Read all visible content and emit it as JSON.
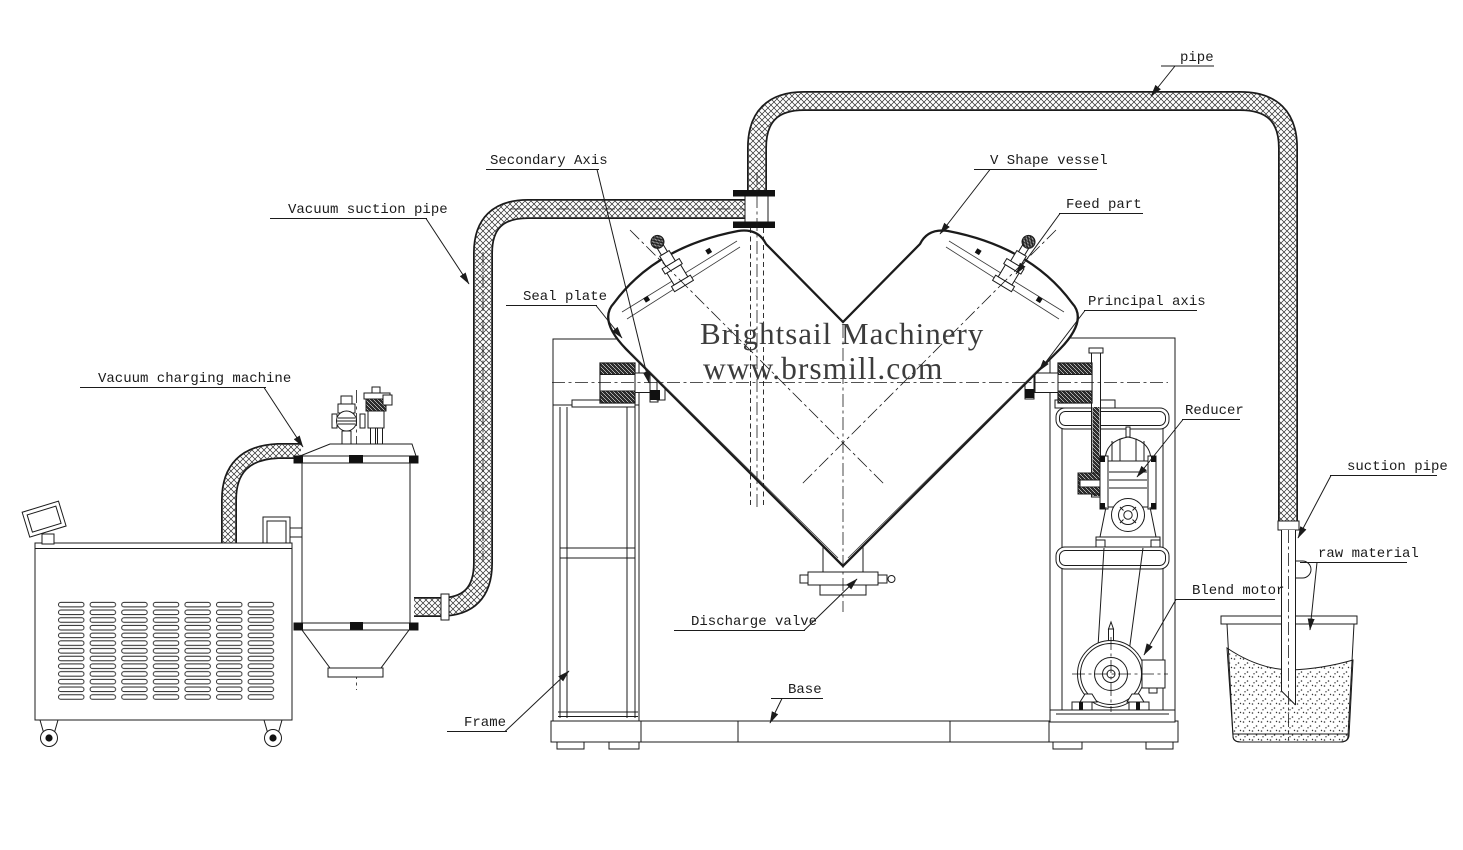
{
  "drawing": {
    "title_watermark": {
      "line1": "Brightsail Machinery",
      "line2": "www.brsmill.com"
    },
    "labels": {
      "pipe": "pipe",
      "secondary_axis": "Secondary Axis",
      "vacuum_suction_pipe": "Vacuum suction pipe",
      "seal_plate": "Seal plate",
      "vacuum_charging_machine": "Vacuum charging machine",
      "v_shape_vessel": "V Shape vessel",
      "feed_part": "Feed part",
      "principal_axis": "Principal axis",
      "reducer": "Reducer",
      "suction_pipe": "suction pipe",
      "raw_material": "raw material",
      "blend_motor": "Blend motor",
      "discharge_valve": "Discharge valve",
      "frame": "Frame",
      "base": "Base"
    },
    "colors": {
      "line": "#1b1b1b",
      "background": "#ffffff",
      "watermark": "#3c3c3c"
    }
  }
}
